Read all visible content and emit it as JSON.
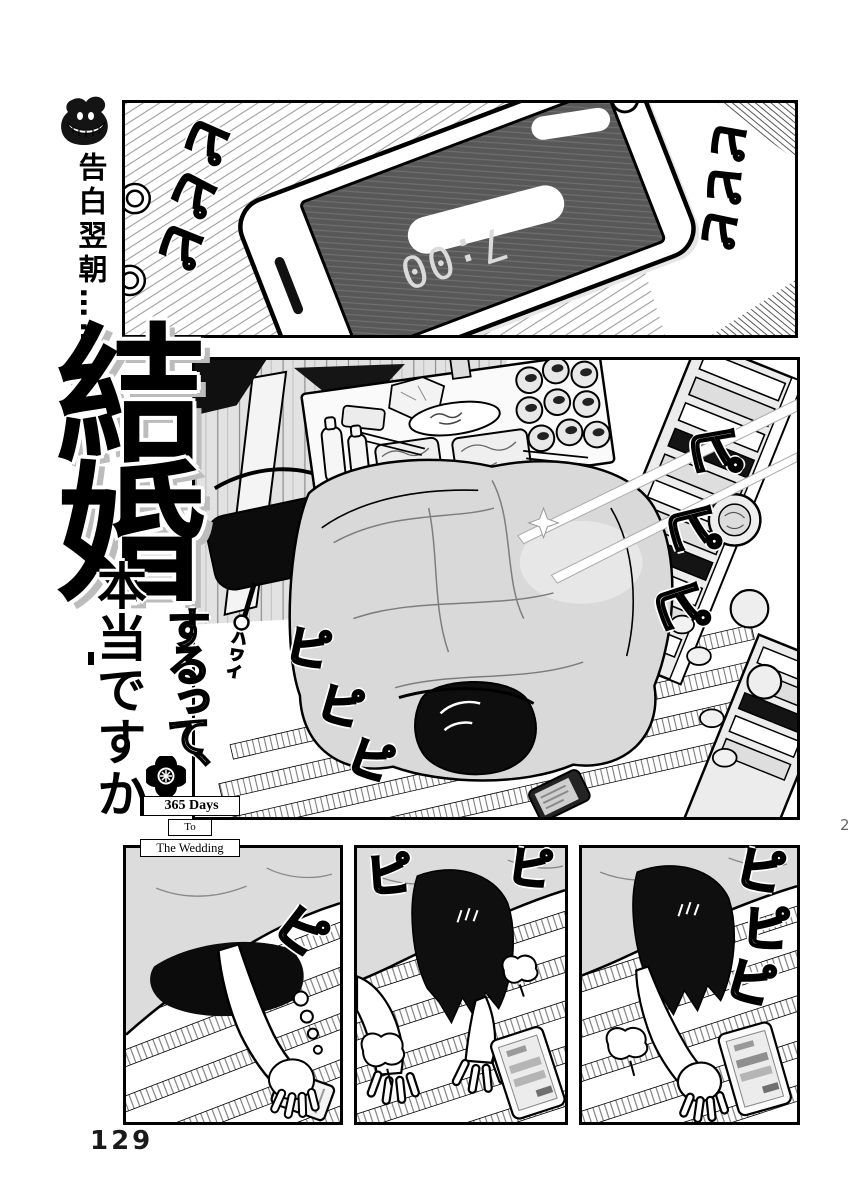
{
  "page": {
    "number": "129",
    "corner_marker": "2"
  },
  "margin": {
    "caption": "告白翌朝……"
  },
  "title": {
    "kanji_1": "結",
    "kanji_2": "婚",
    "episode_number": "2",
    "script_part": "するって、",
    "serif_part": "本当ですか",
    "logo": {
      "line1": "365 Days",
      "line2": "To",
      "line3": "The Wedding"
    }
  },
  "panel_top": {
    "fx_left": [
      "ピ",
      "ピ",
      "ピ"
    ],
    "fx_right": [
      "ピ",
      "ピ",
      "ピ"
    ],
    "phone_time": "7:00"
  },
  "panel_room": {
    "fx_rack": [
      "ピ",
      "ピ",
      "ピ"
    ],
    "fx_floor": [
      "ピ",
      "ピ",
      "ピ"
    ],
    "magazine_title": "ハワイ"
  },
  "panel_b1": {
    "fx": [
      "ピ"
    ]
  },
  "panel_b2": {
    "fx": [
      "ピ",
      "ピ"
    ]
  },
  "panel_b3": {
    "fx": [
      "ピ",
      "ピ",
      "ピ"
    ]
  },
  "colors": {
    "ink": "#000000",
    "paper": "#ffffff",
    "futon_gray": "#d9d9d9",
    "screen_gray": "#595959"
  }
}
